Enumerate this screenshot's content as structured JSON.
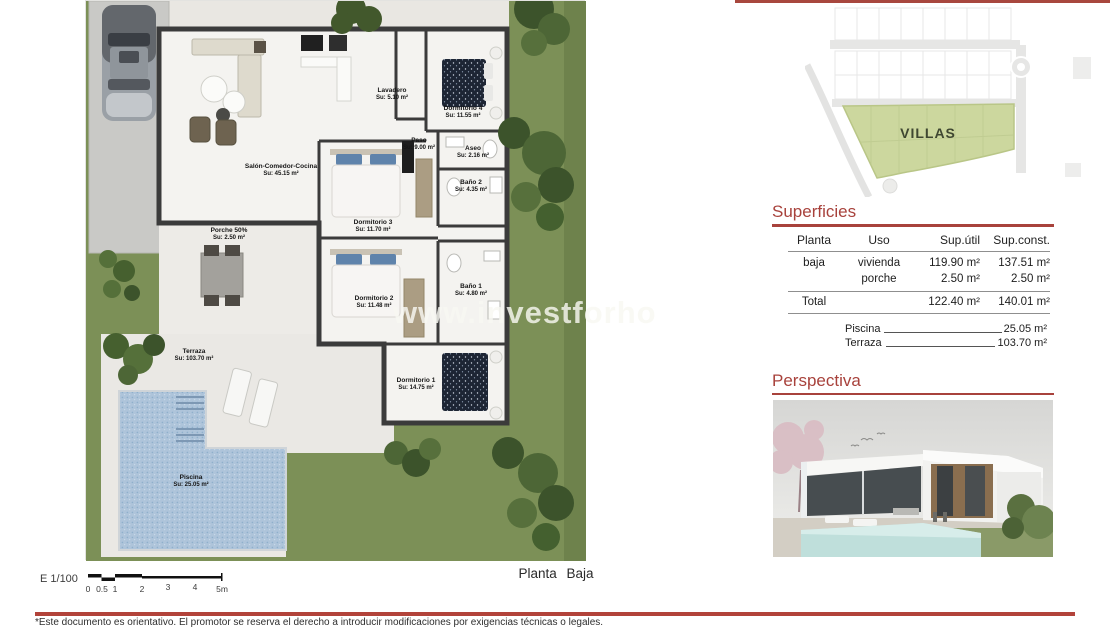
{
  "colors": {
    "accent_red": "#a8423c",
    "lawn_green": "#7c9057",
    "pool_blue": "#aec4da",
    "wall_dark": "#3b3b3b",
    "villas_green": "#ccd79e"
  },
  "site_plan": {
    "label": "VILLAS"
  },
  "superficies": {
    "title": "Superficies",
    "table": {
      "headers": [
        "Planta",
        "Uso",
        "Sup.útil",
        "Sup.const."
      ],
      "rows": [
        {
          "planta": "baja",
          "uso": "vivienda",
          "util": "119.90 m²",
          "const": "137.51 m²"
        },
        {
          "planta": "",
          "uso": "porche",
          "util": "2.50 m²",
          "const": "2.50 m²"
        }
      ],
      "total": {
        "label": "Total",
        "util": "122.40 m²",
        "const": "140.01 m²"
      }
    },
    "extras": [
      {
        "label": "Piscina",
        "value": "25.05 m²"
      },
      {
        "label": "Terraza",
        "value": "103.70 m²"
      }
    ]
  },
  "perspectiva": {
    "title": "Perspectiva"
  },
  "plan": {
    "caption": "Planta Baja",
    "watermark": "www.investforho",
    "scale": {
      "label": "E 1/100",
      "ticks": [
        "0",
        "0.5",
        "1",
        "2",
        "3",
        "4",
        "5m"
      ]
    },
    "rooms": [
      {
        "name": "Salón-Comedor-Cocina",
        "area": "Su: 45.15 m²"
      },
      {
        "name": "Lavadero",
        "area": "Su: 5.10 m²"
      },
      {
        "name": "Paso",
        "area": "Su: 9.00 m²"
      },
      {
        "name": "Dormitorio 4",
        "area": "Su: 11.55 m²"
      },
      {
        "name": "Aseo",
        "area": "Su: 2.16 m²"
      },
      {
        "name": "Baño 2",
        "area": "Su: 4.35 m²"
      },
      {
        "name": "Dormitorio 3",
        "area": "Su: 11.70 m²"
      },
      {
        "name": "Dormitorio 2",
        "area": "Su: 11.48 m²"
      },
      {
        "name": "Baño 1",
        "area": "Su: 4.80 m²"
      },
      {
        "name": "Dormitorio 1",
        "area": "Su: 14.75 m²"
      },
      {
        "name": "Porche 50%",
        "area": "Su: 2.50 m²"
      },
      {
        "name": "Terraza",
        "area": "Su: 103.70 m²"
      },
      {
        "name": "Piscina",
        "area": "Su: 25.05 m²"
      }
    ]
  },
  "footer": {
    "disclaimer": "*Este documento es orientativo. El promotor se reserva el derecho a introducir modificaciones por exigencias técnicas o legales."
  }
}
